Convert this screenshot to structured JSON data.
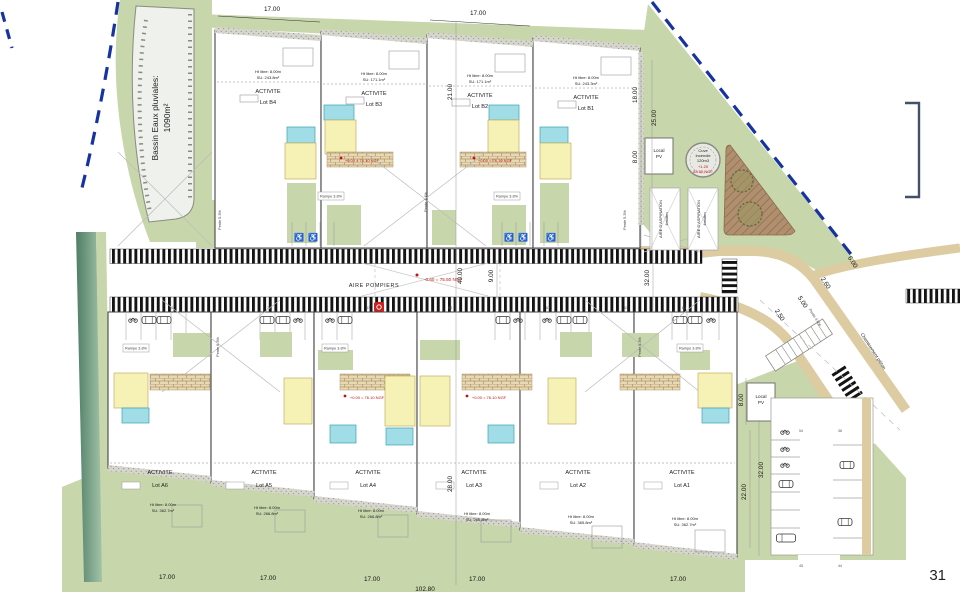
{
  "page": {
    "number": "31"
  },
  "bassin": {
    "line1": "Bassin Eaux pluviales:",
    "line2": "1090m²"
  },
  "lots_b": [
    {
      "activite": "ACTIVITE",
      "lot": "Lot B4",
      "ht": "Ht libre: 8.00m",
      "su": "SU: 243.8m²"
    },
    {
      "activite": "ACTIVITE",
      "lot": "Lot B3",
      "ht": "Ht libre: 8.00m",
      "su": "SU: 171.1m²"
    },
    {
      "activite": "ACTIVITE",
      "lot": "Lot B2",
      "ht": "Ht libre: 8.00m",
      "su": "SU: 171.1m²"
    },
    {
      "activite": "ACTIVITE",
      "lot": "Lot B1",
      "ht": "Ht libre: 8.00m",
      "su": "SU: 243.3m²"
    }
  ],
  "lots_a": [
    {
      "activite": "ACTIVITE",
      "lot": "Lot A6",
      "ht": "Ht libre: 8.00m",
      "su": "SU: 362.7m²"
    },
    {
      "activite": "ACTIVITE",
      "lot": "Lot A5",
      "ht": "Ht libre: 8.00m",
      "su": "SU: 266.8m²"
    },
    {
      "activite": "ACTIVITE",
      "lot": "Lot A4",
      "ht": "Ht libre: 8.00m",
      "su": "SU: 266.8m²"
    },
    {
      "activite": "ACTIVITE",
      "lot": "Lot A3",
      "ht": "Ht libre: 8.00m",
      "su": "SU: 266.8m²"
    },
    {
      "activite": "ACTIVITE",
      "lot": "Lot A2",
      "ht": "Ht libre: 8.00m",
      "su": "SU: 365.8m²"
    },
    {
      "activite": "ACTIVITE",
      "lot": "Lot A1",
      "ht": "Ht libre: 8.00m",
      "su": "SU: 362.7m²"
    }
  ],
  "road": {
    "aire_pompiers": "AIRE POMPIERS",
    "level_center": "-0.60 = 75.50 NGF",
    "level_entry": "+0.00 = 76.10 NGF",
    "cheminement": "Cheminement piéton"
  },
  "cuve": {
    "l1": "Cuve",
    "l2": "Incendie",
    "l3": "120m3",
    "l4": "+1.20",
    "l5": "83.50 NGF"
  },
  "local_pv": {
    "l1": "Local",
    "l2": "PV"
  },
  "aspiration": {
    "l1": "AIRE D'ASPIRATION",
    "l2": "4mx8m"
  },
  "slopes": {
    "pente44": "Pente 4.4%",
    "pente53": "Pente 5.3%",
    "pente63": "Pente 6.3%",
    "pente40": "Pente 4.0%",
    "rampe38": "Rampe 3.8%"
  },
  "dims": {
    "d17": "17.00",
    "d2100": "21.00",
    "d2800": "28.00",
    "d4000": "40.00",
    "d900": "9.00",
    "d3200": "32.00",
    "d1800": "18.00",
    "d2500": "25.00",
    "d800": "8.00",
    "d2200": "22.00",
    "d10280": "102.80",
    "d600": "6.00",
    "d260": "2.60",
    "d250": "2.50",
    "d500": "5.00"
  },
  "stalls": {
    "n74": "74",
    "n72": "72",
    "n67": "67",
    "n64": "64",
    "n61": "61",
    "n58": "58",
    "n57": "57",
    "n54": "54",
    "n45": "45",
    "n44": "44",
    "n36": "36"
  }
}
